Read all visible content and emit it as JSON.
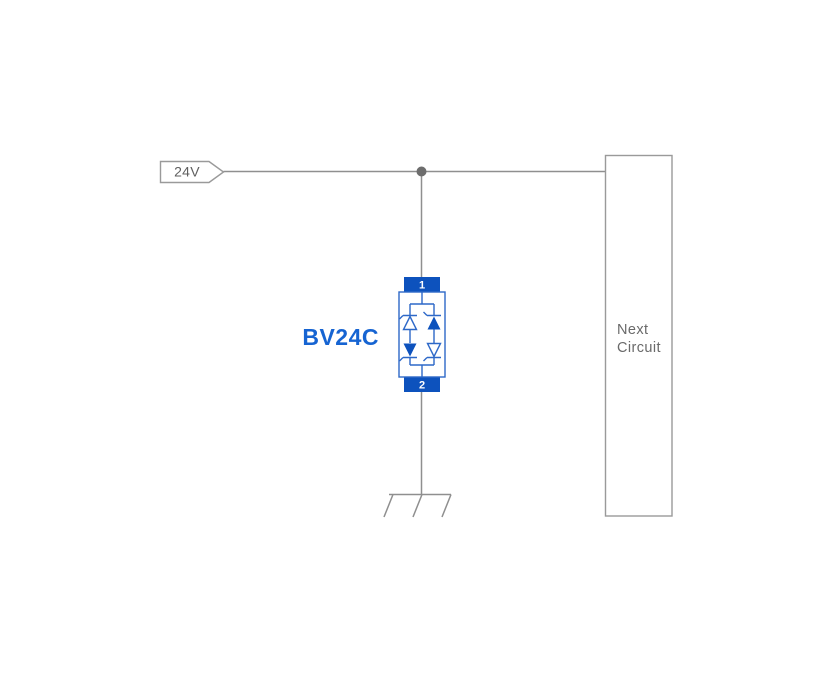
{
  "diagram": {
    "power_label": "24V",
    "component": {
      "name": "BV24C",
      "terminal_top": "1",
      "terminal_bottom": "2"
    },
    "next_circuit": {
      "line1": "Next",
      "line2": "Circuit"
    },
    "colors": {
      "component_blue_fill": "#0d52bd",
      "component_blue_outline": "#2d68c8",
      "component_label_blue": "#1664d2",
      "wire_gray": "#8f8f8f",
      "shape_outline_gray": "#9a9a9a",
      "text_gray": "#5f5f5f",
      "junction_dot_gray": "#6d6d6d",
      "background": "#ffffff"
    }
  }
}
